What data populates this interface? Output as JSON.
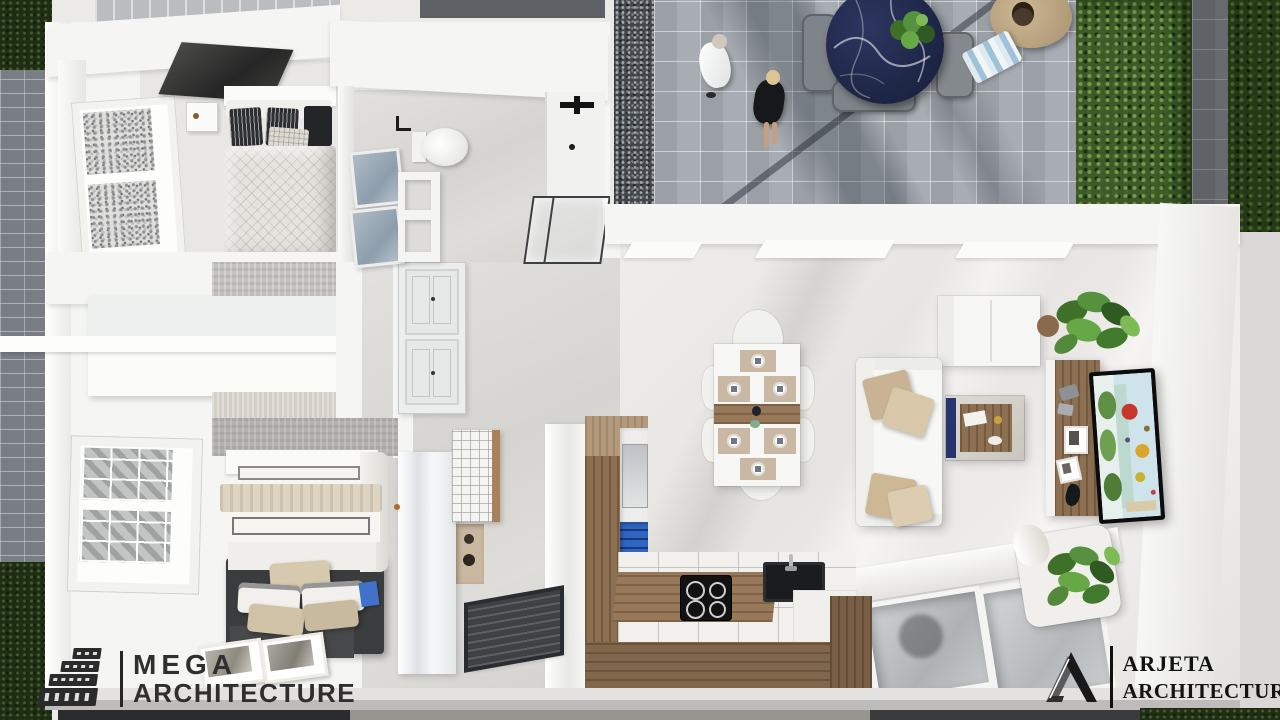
{
  "branding": {
    "mega": {
      "line1": "MEGA",
      "line2": "ARCHITECTURE"
    },
    "arjeta": {
      "line1": "ARJETA",
      "line2": "ARCHITECTURE"
    }
  },
  "colors": {
    "wall_white": "#f5f5f3",
    "floor_light": "#eceae7",
    "marble_floor": "#d8d7d3",
    "paver_gray": "#a8aeb3",
    "gravel_dark": "#43474b",
    "hedge_green": "#3e5a2a",
    "hedge_dark": "#243a18",
    "plant_green": "#55913e",
    "wood": "#97795a",
    "wood_dark": "#7d644a",
    "navy_table": "#222b4d",
    "entry_mat_dark": "#3e4143",
    "pillow_beige": "#c9b394",
    "logo_dark": "#2b2b2b",
    "fridge_blue": "#2f66c4",
    "tv_sky": "#cfe4ea",
    "tv_green": "#5f8f45",
    "tv_red": "#c5372b",
    "tv_yellow": "#d9a62d"
  }
}
